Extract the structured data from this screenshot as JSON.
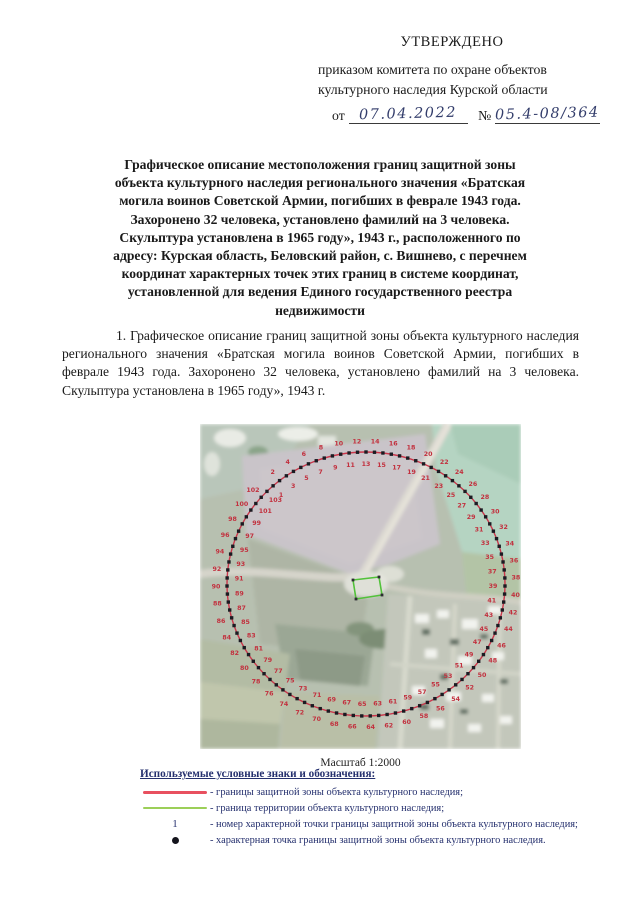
{
  "approval": {
    "title": "УТВЕРЖДЕНО",
    "line1": "приказом комитета по охране объектов",
    "line2": "культурного наследия Курской области",
    "from_label": "от",
    "date_value": "07.04.2022",
    "number_label": "№",
    "number_value": "05.4-08/364"
  },
  "heading": {
    "lines": [
      "Графическое описание местоположения границ защитной зоны",
      "объекта культурного наследия регионального значения «Братская",
      "могила воинов Советской Армии, погибших в феврале 1943 года.",
      "Захоронено 32 человека, установлено фамилий на 3 человека.",
      "Скульптура установлена в 1965 году», 1943 г., расположенного по",
      "адресу: Курская область, Беловский район, с. Вишнево, с перечнем",
      "координат характерных точек этих границ в системе координат,",
      "установленной для ведения Единого государственного реестра",
      "недвижимости"
    ]
  },
  "paragraph": {
    "text": "1. Графическое описание границ защитной зоны объекта культурного наследия регионального значения «Братская могила воинов Советской Армии, погибших в феврале 1943 года. Захоронено 32 человека, установлено фамилий на 3 человека. Скульптура установлена в 1965 году», 1943 г."
  },
  "map": {
    "caption": "Масштаб 1:2000",
    "point_labels": [
      1,
      2,
      3,
      4,
      5,
      6,
      7,
      8,
      9,
      10,
      11,
      12,
      13,
      14,
      15,
      16,
      17,
      18,
      19,
      20,
      21,
      22,
      23,
      24,
      25,
      26,
      27,
      28,
      29,
      30,
      31,
      32,
      33,
      34,
      35,
      36,
      37,
      38,
      39,
      40,
      41,
      42,
      43,
      44,
      45,
      46,
      47,
      48,
      49,
      50,
      51,
      52,
      53,
      54,
      55,
      56,
      57,
      58,
      59,
      60,
      61,
      62,
      63,
      64,
      65,
      66,
      67,
      68,
      69,
      70,
      71,
      72,
      73,
      74,
      75,
      76,
      77,
      78,
      79,
      80,
      81,
      82,
      83,
      84,
      85,
      86,
      87,
      88,
      89,
      90,
      91,
      92,
      93,
      94,
      95,
      96,
      97,
      98,
      99,
      100,
      101,
      102,
      103
    ],
    "territory_points": "153,156 179,153 182,171 156,175",
    "colors": {
      "zone_boundary": "#c9374b",
      "zone_boundary_legend": "#e8505f",
      "territory_boundary": "#52c23a",
      "territory_boundary_legend": "#9ccf58",
      "point_number": "#c2303e",
      "point_dot": "#1b1b22",
      "legend_text": "#25306e",
      "ink": "#333d6b"
    }
  },
  "legend": {
    "title": "Используемые условные знаки и обозначения:",
    "items": [
      {
        "symbol": "zone-line",
        "text": "- границы защитной зоны объекта культурного наследия;"
      },
      {
        "symbol": "territory-line",
        "text": "- граница территории объекта культурного наследия;"
      },
      {
        "symbol": "point-number",
        "symbol_text": "1",
        "text": "- номер характерной точки границы защитной зоны объекта культурного наследия;"
      },
      {
        "symbol": "point-dot",
        "text": "- характерная точка границы защитной зоны объекта культурного наследия."
      }
    ]
  }
}
